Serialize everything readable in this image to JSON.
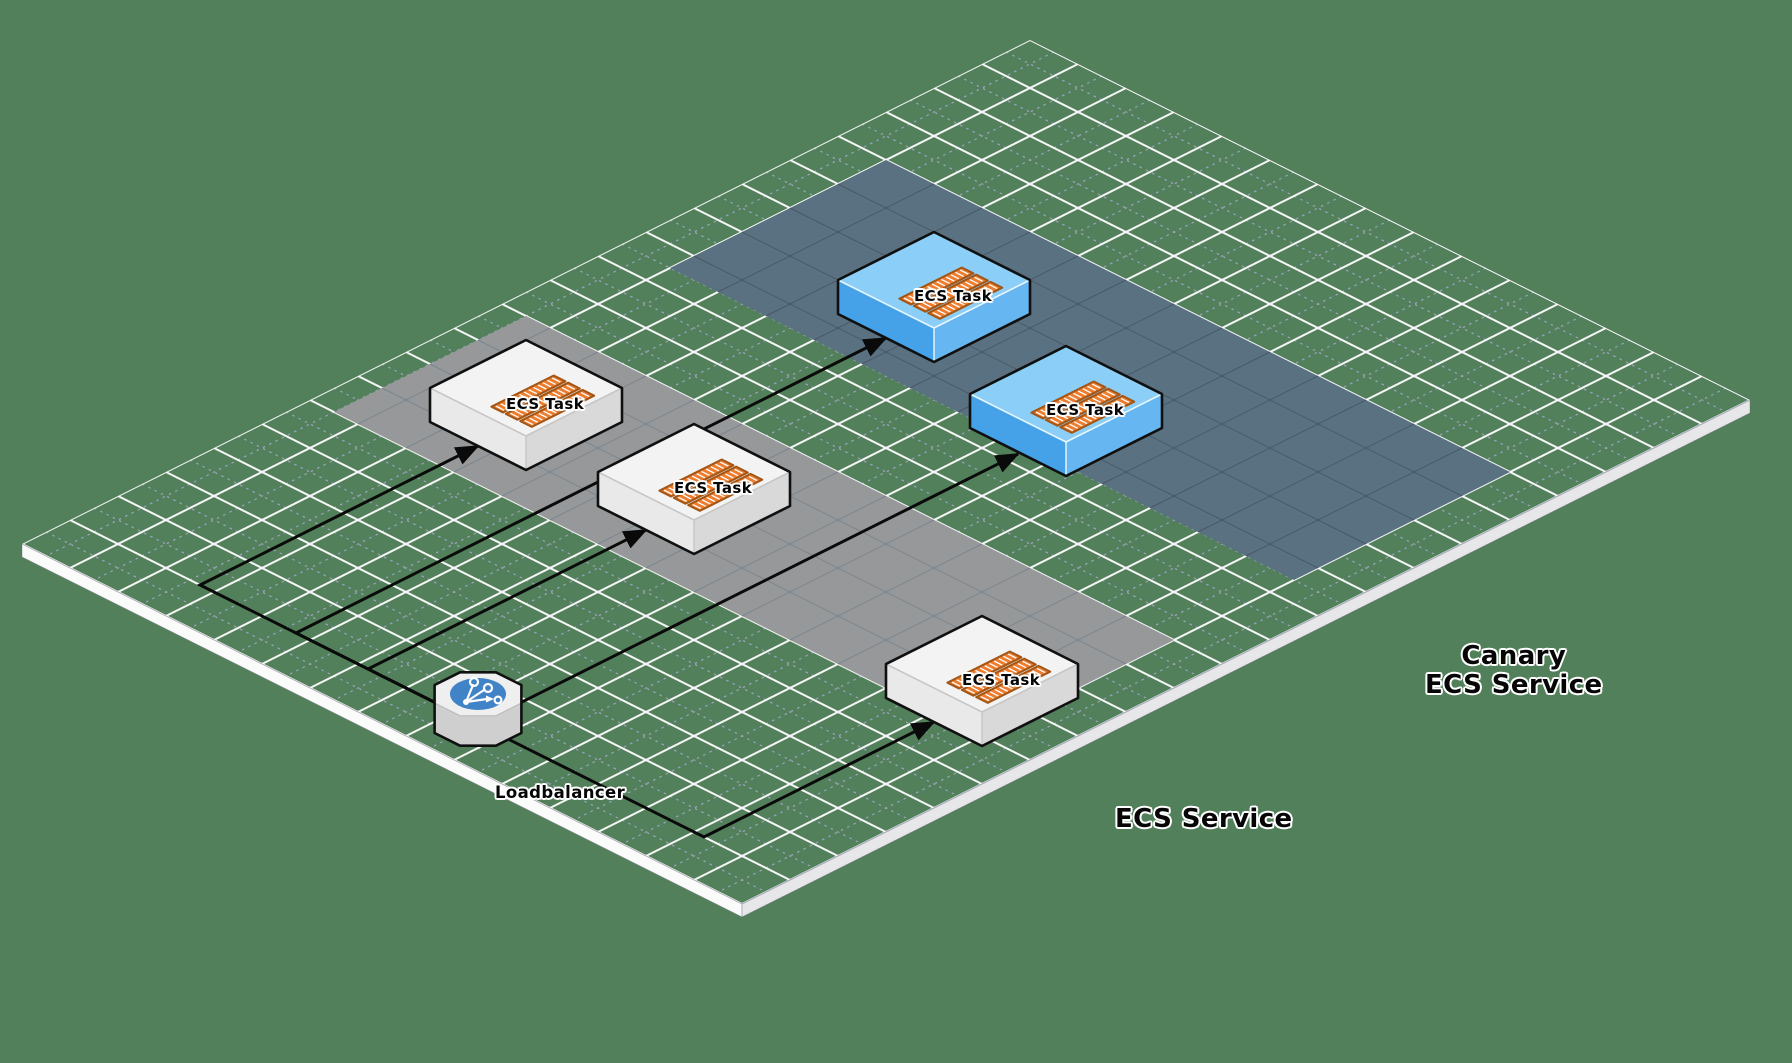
{
  "canvas": {
    "width": 1792,
    "height": 1063,
    "background_color": "#52805a"
  },
  "diagram": {
    "iso": {
      "origin": [
        1030,
        40
      ],
      "cell": [
        48,
        24
      ],
      "plane_cols": 15,
      "plane_rows": 21,
      "edge_thickness": 13
    },
    "grid": {
      "major_color": "#f7f7f7",
      "minor_color": "#a6a9cf",
      "sw_edge_color": "#fbfbfb",
      "se_edge_color": "#e7e7ea",
      "edge_seam_color": "#a9aeb8"
    },
    "lanes": [
      {
        "id": "ecs-service",
        "rect": [
          0.5,
          11,
          14,
          15
        ],
        "fill": "#969899",
        "grid_line": "rgba(70,100,130,0.35)"
      },
      {
        "id": "canary-ecs-service",
        "rect": [
          1,
          4,
          14,
          8.5
        ],
        "fill": "#5a7181",
        "grid_line": "rgba(10,25,35,0.25)"
      }
    ],
    "palettes": {
      "white": {
        "top": "#f3f3f3",
        "left": "#e9e9e9",
        "right": "#d9d9d9",
        "seam": "#c6c6c6",
        "outline": "#101010"
      },
      "blue": {
        "top": "#8bcef8",
        "left": "#45a2e9",
        "right": "#66b6f2",
        "seam": "#eaf7ff",
        "outline": "#101010"
      }
    },
    "container_style": {
      "fill": "#ed7d2f",
      "border": "#a35615",
      "stripe": "#ffffff"
    },
    "nodes": [
      {
        "id": "ecs-task-1",
        "label": "ECS Task",
        "palette": "white",
        "iso": [
          1,
          11.5
        ],
        "size": 2,
        "label_pos": [
          506,
          396
        ]
      },
      {
        "id": "ecs-task-2",
        "label": "ECS Task",
        "palette": "white",
        "iso": [
          4.5,
          11.5
        ],
        "size": 2,
        "label_pos": [
          674,
          480
        ]
      },
      {
        "id": "ecs-task-3",
        "label": "ECS Task",
        "palette": "white",
        "iso": [
          11.5,
          12.5
        ],
        "size": 2,
        "label_pos": [
          962,
          672
        ]
      },
      {
        "id": "canary-ecs-task-1",
        "label": "ECS Task",
        "palette": "blue",
        "iso": [
          3,
          5
        ],
        "size": 2,
        "label_pos": [
          914,
          288
        ]
      },
      {
        "id": "canary-ecs-task-2",
        "label": "ECS Task",
        "palette": "blue",
        "iso": [
          6.75,
          6
        ],
        "size": 2,
        "label_pos": [
          1046,
          402
        ]
      }
    ],
    "loadbalancer": {
      "id": "loadbalancer",
      "iso_center": [
        8.5,
        20
      ],
      "radius": 47,
      "height": 30,
      "top_fill": "#efefef",
      "side_fill": "#cfcfcf",
      "top_seam": "#b9b9b9",
      "circle_fill": "#4083c6",
      "icon_color": "#ffffff",
      "outline": "#101010"
    },
    "connector_style": {
      "color": "#0a0a0a",
      "width": 3
    },
    "connectors": [
      {
        "id": "lb-to-ecs-task-1",
        "points": [
          [
            478,
            724
          ],
          [
            200,
            585
          ],
          [
            478,
            446
          ]
        ]
      },
      {
        "id": "lb-to-ecs-task-2",
        "points": [
          [
            478,
            724
          ],
          [
            368,
            669
          ],
          [
            646,
            530
          ]
        ]
      },
      {
        "id": "lb-to-ecs-task-3",
        "points": [
          [
            478,
            724
          ],
          [
            704,
            837
          ],
          [
            934,
            722
          ]
        ]
      },
      {
        "id": "lb-to-canary-ecs-task-1",
        "points": [
          [
            478,
            724
          ],
          [
            296,
            633
          ],
          [
            886,
            338
          ]
        ]
      },
      {
        "id": "lb-to-canary-ecs-task-2",
        "points": [
          [
            478,
            724
          ],
          [
            1018,
            454
          ]
        ]
      }
    ],
    "floor_labels": [
      {
        "id": "ecs-service-label",
        "text": "ECS Service",
        "pos": [
          1115,
          805
        ]
      },
      {
        "id": "canary-ecs-service-label",
        "text": "Canary\nECS Service",
        "pos": [
          1425,
          642
        ]
      },
      {
        "id": "loadbalancer-label",
        "text": "Loadbalancer",
        "pos": [
          495,
          784
        ]
      }
    ]
  }
}
